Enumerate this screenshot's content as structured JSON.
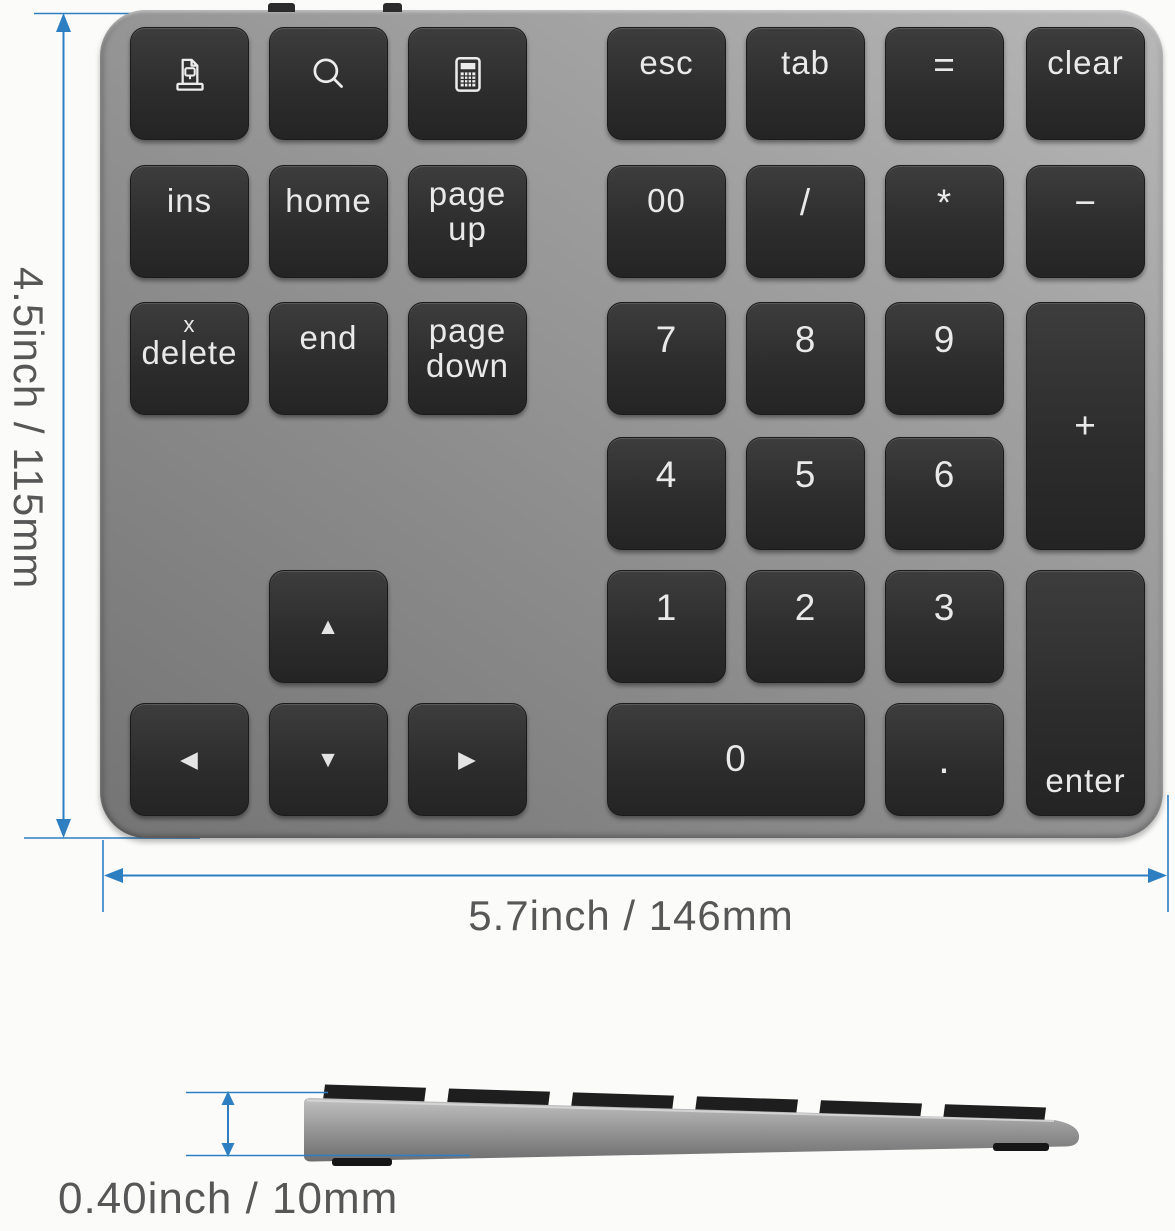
{
  "dimensions": {
    "height_label": "4.5inch / 115mm",
    "width_label": "5.7inch / 146mm",
    "thickness_label": "0.40inch / 10mm"
  },
  "colors": {
    "dimension_line": "#2e7fc2",
    "dimension_text": "#575757",
    "key_face": "#2e2e2e",
    "body_gray": "#8e8e8e"
  },
  "product_view": {
    "top_edge_switches": 2,
    "keys": [
      {
        "name": "key-screen-doc",
        "icon": "screen-doc-icon",
        "col": 0,
        "row": 0
      },
      {
        "name": "key-search",
        "icon": "search-icon",
        "col": 1,
        "row": 0
      },
      {
        "name": "key-calculator",
        "icon": "calculator-icon",
        "col": 2,
        "row": 0
      },
      {
        "name": "key-esc",
        "label": "esc",
        "col": 3,
        "row": 0
      },
      {
        "name": "key-tab",
        "label": "tab",
        "col": 4,
        "row": 0
      },
      {
        "name": "key-equals",
        "label": "=",
        "col": 5,
        "row": 0,
        "cls": "sym"
      },
      {
        "name": "key-clear",
        "label": "clear",
        "col": 6,
        "row": 0
      },
      {
        "name": "key-ins",
        "label": "ins",
        "col": 0,
        "row": 1
      },
      {
        "name": "key-home",
        "label": "home",
        "col": 1,
        "row": 1
      },
      {
        "name": "key-page-up",
        "lines": [
          "page",
          "up"
        ],
        "col": 2,
        "row": 1
      },
      {
        "name": "key-double-zero",
        "label": "00",
        "col": 3,
        "row": 1
      },
      {
        "name": "key-divide",
        "label": "/",
        "col": 4,
        "row": 1,
        "cls": "sym"
      },
      {
        "name": "key-multiply",
        "label": "*",
        "col": 5,
        "row": 1,
        "cls": "sym"
      },
      {
        "name": "key-minus",
        "label": "−",
        "col": 6,
        "row": 1,
        "cls": "sym"
      },
      {
        "name": "key-delete",
        "lines": [
          "x",
          "delete"
        ],
        "col": 0,
        "row": 2,
        "small_first": true
      },
      {
        "name": "key-end",
        "label": "end",
        "col": 1,
        "row": 2
      },
      {
        "name": "key-page-down",
        "lines": [
          "page",
          "down"
        ],
        "col": 2,
        "row": 2
      },
      {
        "name": "key-7",
        "label": "7",
        "col": 3,
        "row": 2,
        "cls": "num"
      },
      {
        "name": "key-8",
        "label": "8",
        "col": 4,
        "row": 2,
        "cls": "num"
      },
      {
        "name": "key-9",
        "label": "9",
        "col": 5,
        "row": 2,
        "cls": "num"
      },
      {
        "name": "key-plus",
        "label": "+",
        "col": 6,
        "row": 2,
        "rowspan": 2,
        "valign": "center",
        "cls": "sym"
      },
      {
        "name": "key-4",
        "label": "4",
        "col": 3,
        "row": 3,
        "cls": "num"
      },
      {
        "name": "key-5",
        "label": "5",
        "col": 4,
        "row": 3,
        "cls": "num"
      },
      {
        "name": "key-6",
        "label": "6",
        "col": 5,
        "row": 3,
        "cls": "num"
      },
      {
        "name": "key-arrow-up",
        "label": "▲",
        "col": 1,
        "row": 4,
        "valign": "center",
        "cls": "arrow"
      },
      {
        "name": "key-1",
        "label": "1",
        "col": 3,
        "row": 4,
        "cls": "num"
      },
      {
        "name": "key-2",
        "label": "2",
        "col": 4,
        "row": 4,
        "cls": "num"
      },
      {
        "name": "key-3",
        "label": "3",
        "col": 5,
        "row": 4,
        "cls": "num"
      },
      {
        "name": "key-enter",
        "label": "enter",
        "col": 6,
        "row": 4,
        "rowspan": 2,
        "valign": "bottom"
      },
      {
        "name": "key-arrow-left",
        "label": "◀",
        "col": 0,
        "row": 5,
        "valign": "center",
        "cls": "arrow"
      },
      {
        "name": "key-arrow-down",
        "label": "▼",
        "col": 1,
        "row": 5,
        "valign": "center",
        "cls": "arrow"
      },
      {
        "name": "key-arrow-right",
        "label": "▶",
        "col": 2,
        "row": 5,
        "valign": "center",
        "cls": "arrow"
      },
      {
        "name": "key-0",
        "label": "0",
        "col": 3,
        "row": 5,
        "colspan": 2,
        "valign": "center",
        "cls": "num"
      },
      {
        "name": "key-decimal",
        "label": ".",
        "col": 5,
        "row": 5,
        "valign": "center",
        "cls": "dot"
      }
    ]
  },
  "side_view": {
    "keycap_count": 6,
    "feet_count": 2
  }
}
